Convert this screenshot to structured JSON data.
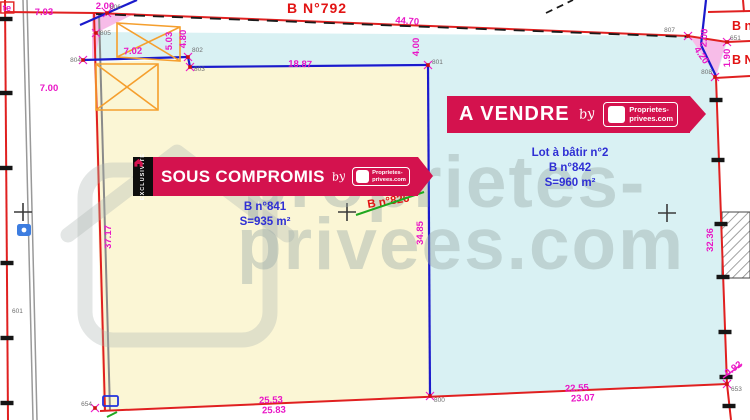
{
  "plan": {
    "corner_label": "te",
    "parcels": {
      "top": "B N°792",
      "right_top": "B n°",
      "right_mid": "B N°",
      "struck": "B n°826"
    },
    "lots": [
      {
        "name": "Lot à bâtir n°1",
        "parcel": "B n°841",
        "area": "S=935 m²"
      },
      {
        "name": "Lot à bâtir n°2",
        "parcel": "B n°842",
        "area": "S=960 m²"
      }
    ],
    "dims": [
      "7.03",
      "2.00",
      "7.00",
      "7.02",
      "5.03",
      "4.80",
      "44.70",
      "4.00",
      "18.87",
      "37.17",
      "34.85",
      "32.36",
      "2.00",
      "1.90",
      "4.20",
      "25.53",
      "25.83",
      "22.55",
      "23.07",
      "0.92"
    ],
    "points": [
      "800",
      "801",
      "802",
      "803",
      "804",
      "805",
      "806",
      "807",
      "808",
      "651",
      "653",
      "654",
      "601"
    ]
  },
  "banners": {
    "sous_compromis": {
      "tag": "EXCLUSIVITE",
      "label": "SOUS COMPROMIS",
      "by": "by",
      "logo_line1": "Proprietes-",
      "logo_line2": "privees.com"
    },
    "a_vendre": {
      "label": "A VENDRE",
      "by": "by",
      "logo_line1": "Proprietes-",
      "logo_line2": "privees.com"
    }
  },
  "watermark": {
    "line1": "proprietes-",
    "line2": "privees.com"
  },
  "colors": {
    "banner_red": "#d4124e",
    "measurement_magenta": "#e916c6",
    "lot_text_blue": "#2f2fd4",
    "parcel_text_red": "#e21414",
    "lot1_fill": "#fbf6d5",
    "lot2_fill": "#d9f1f3",
    "boundary_red": "#e02020",
    "survey_blue": "#1a1acc",
    "hatch_orange": "#f59f2e"
  }
}
